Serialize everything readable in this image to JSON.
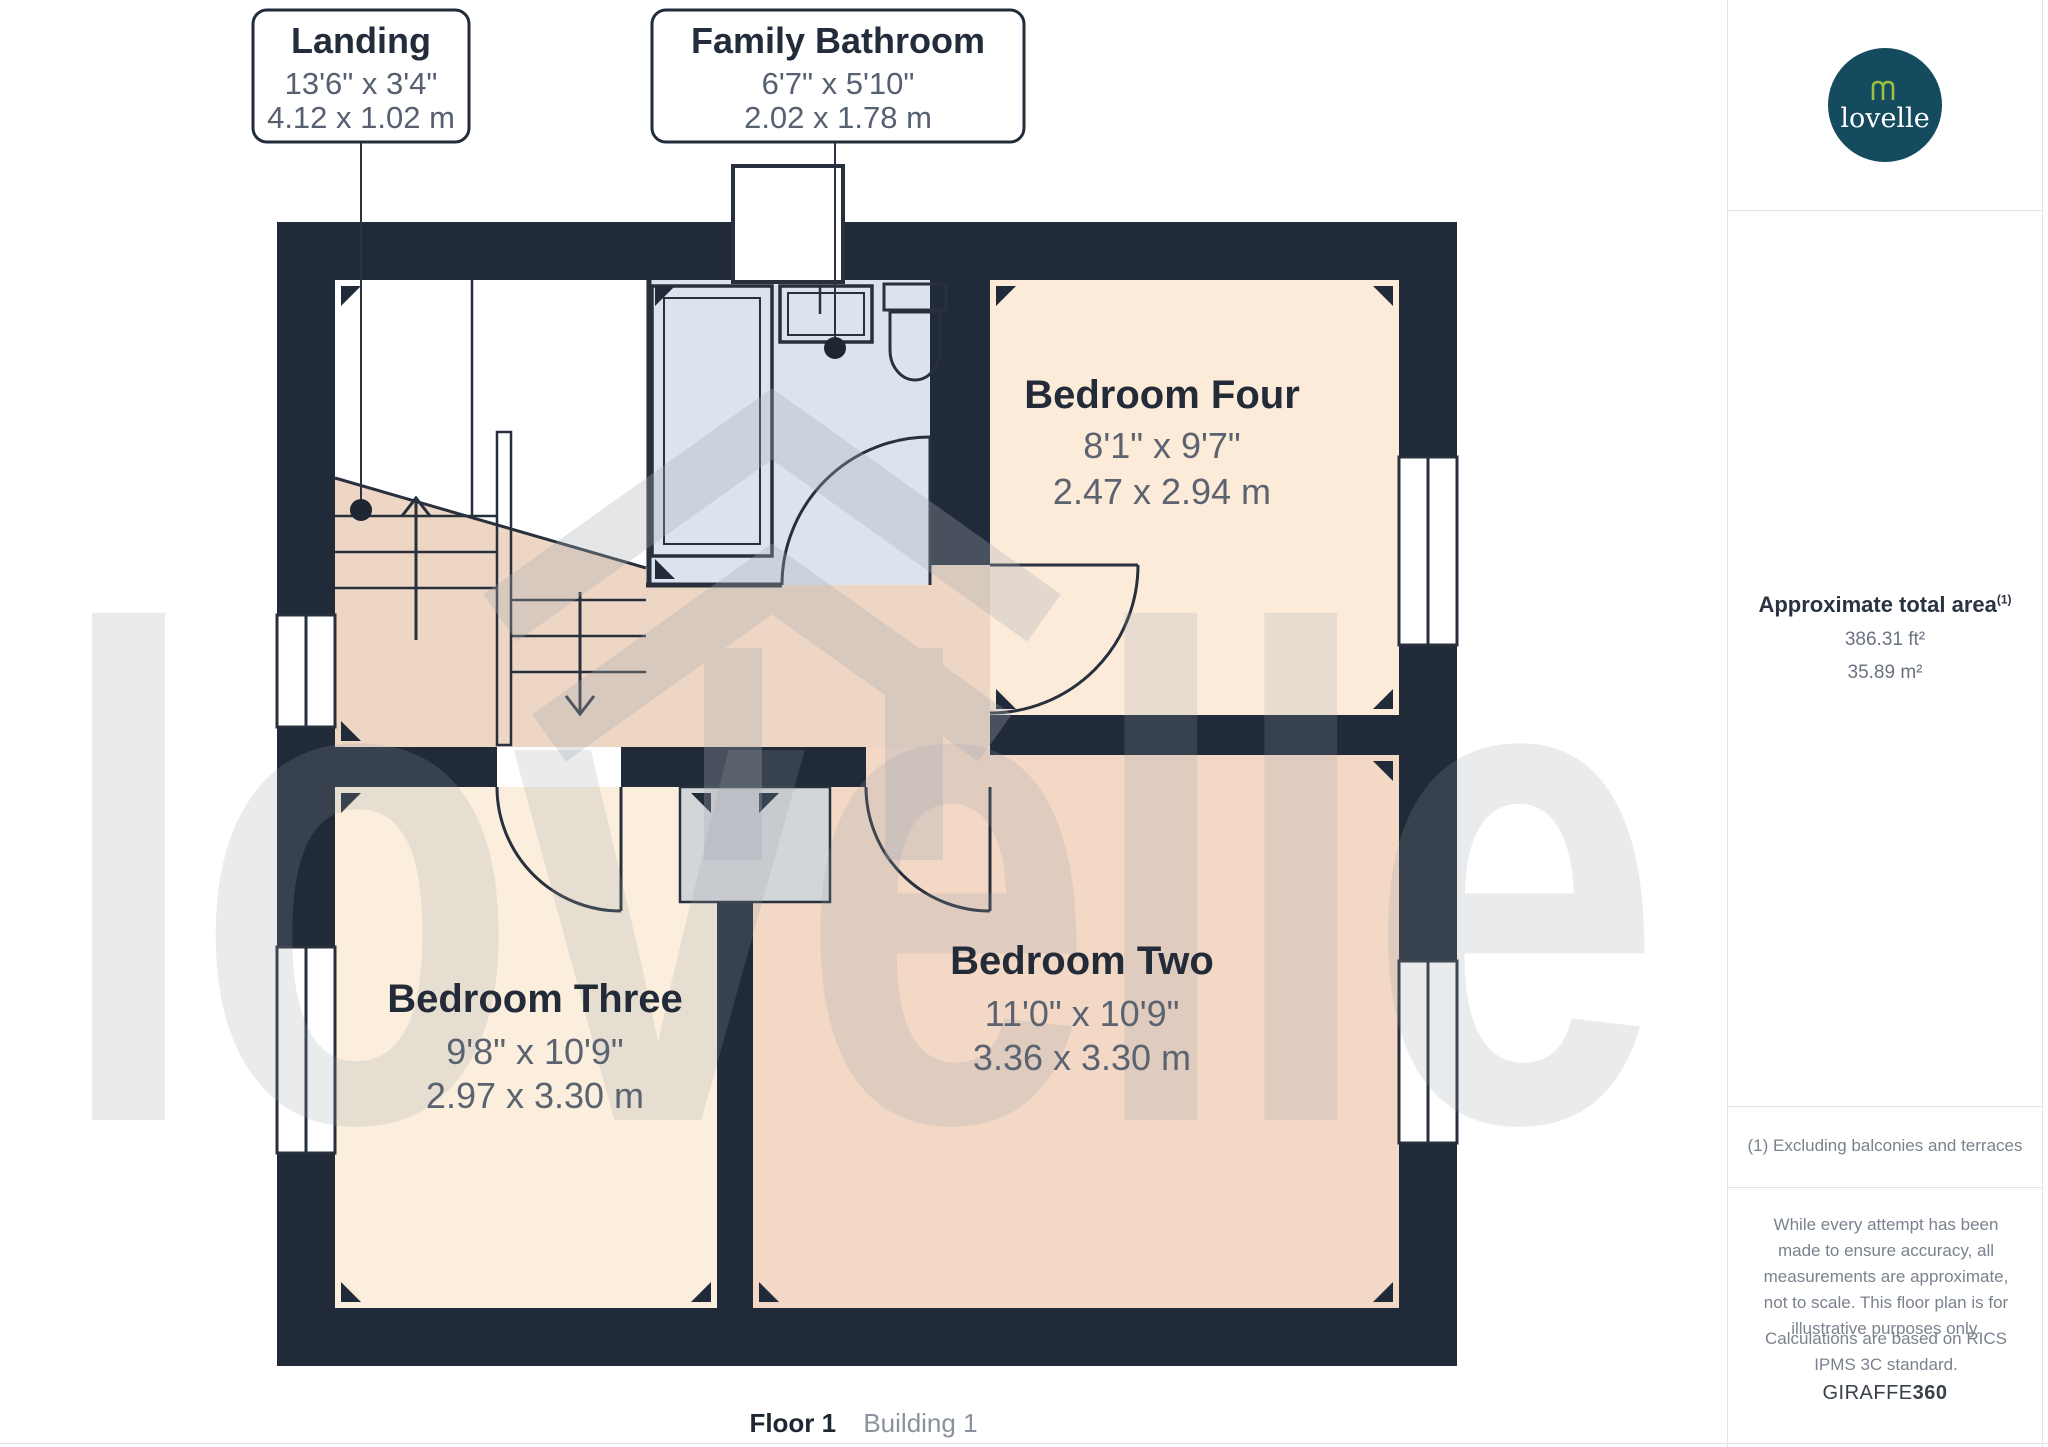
{
  "callouts": [
    {
      "title": "Landing",
      "imperial": "13'6\" x 3'4\"",
      "metric": "4.12 x 1.02 m"
    },
    {
      "title": "Family Bathroom",
      "imperial": "6'7\" x 5'10\"",
      "metric": "2.02 x 1.78 m"
    }
  ],
  "rooms": [
    {
      "name": "Bedroom Four",
      "imperial": "8'1\" x 9'7\"",
      "metric": "2.47 x 2.94 m"
    },
    {
      "name": "Bedroom Three",
      "imperial": "9'8\" x 10'9\"",
      "metric": "2.97 x 3.30 m"
    },
    {
      "name": "Bedroom Two",
      "imperial": "11'0\" x 10'9\"",
      "metric": "3.36 x 3.30 m"
    }
  ],
  "sidebar": {
    "logo_text": "lovelle",
    "area_heading": "Approximate total area",
    "area_superscript": "(1)",
    "area_ft": "386.31 ft²",
    "area_m": "35.89 m²",
    "footnote": "(1) Excluding balconies and terraces",
    "disclaimer": "While every attempt has been made to ensure accuracy, all measurements are approximate, not to scale. This floor plan is for illustrative purposes only.",
    "calculations": "Calculations are based on RICS IPMS 3C standard.",
    "brand": "GIRAFFE",
    "brand_bold": "360"
  },
  "footer": {
    "floor_label": "Floor 1",
    "building_label": "Building 1"
  },
  "watermark_text": "lovelle",
  "colors": {
    "wall": "#202a38",
    "bathroom_floor": "#dde3ee",
    "bedroom_four_floor": "#fcebd9",
    "bedroom_three_floor": "#fbeedd",
    "bedroom_two_floor": "#f3d8c6",
    "landing_floor": "#eed6c4",
    "cupboard": "#d3d6d9",
    "logo_bg": "#144b5e",
    "logo_glyph": "#9dc23b"
  }
}
